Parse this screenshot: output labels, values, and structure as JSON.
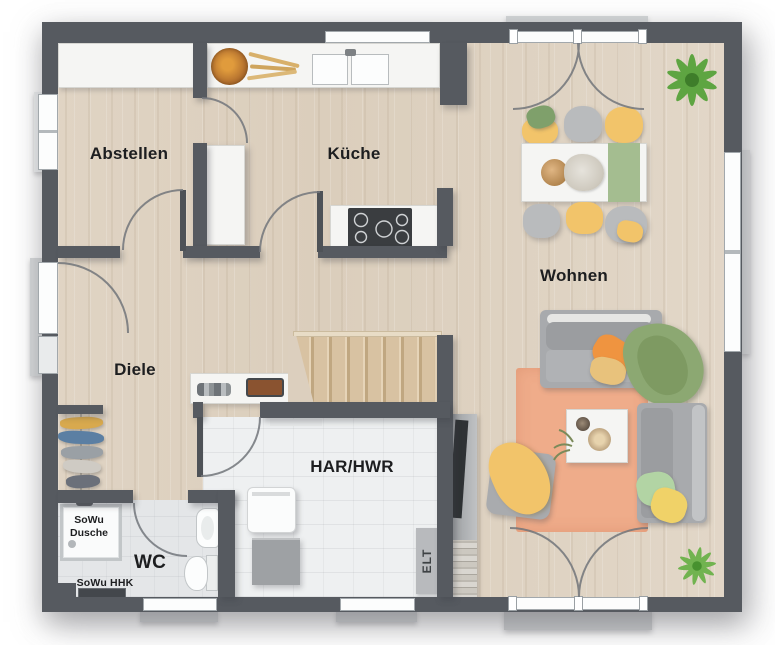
{
  "plan_type": "residential-floor-plan-ground-floor",
  "rooms": {
    "abstellen": {
      "label": "Abstellen"
    },
    "kueche": {
      "label": "Küche"
    },
    "wohnen": {
      "label": "Wohnen"
    },
    "diele": {
      "label": "Diele"
    },
    "har_hwr": {
      "label": "HAR/HWR"
    },
    "wc": {
      "label": "WC"
    }
  },
  "annotations": {
    "sowu_dusche_line1": "SoWu",
    "sowu_dusche_line2": "Dusche",
    "sowu_hhk": "SoWu HHK",
    "elt": "ELT"
  },
  "palette": {
    "wall": "#565a60",
    "wood_floor": "#ddd1c1",
    "tile_floor": "#eef0f1",
    "stairs_wood": "#d5bf9f",
    "rug": "#efac8a",
    "accent_yellow": "#f2c46a",
    "accent_orange": "#ef9440",
    "accent_green": "#8ca872",
    "plant_green": "#58a33b",
    "label_text": "#1d1e20"
  }
}
